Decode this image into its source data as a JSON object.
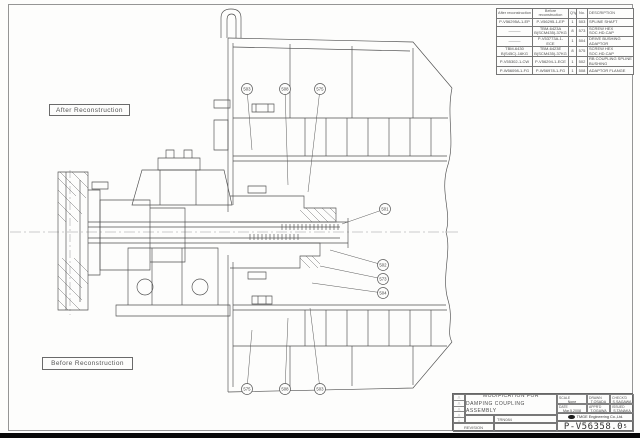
{
  "labels": {
    "after": "After Reconstruction",
    "before": "Before Reconstruction"
  },
  "parts_table": {
    "headers": [
      "After reconstruction",
      "Before reconstruction",
      "Q'ty",
      "No.",
      "DESCRIPTION"
    ],
    "rows": [
      [
        "P-V56295A-1-EP",
        "P-V56295-1-EP",
        "1",
        "503",
        "SPLINE SHAFT"
      ],
      [
        "———",
        "TBM-6423A B(SCM435)-37KG",
        "8",
        "573",
        "SCREW HEX SOC.HD.CAP"
      ],
      [
        "———",
        "P-V53773A-1-ECE",
        "1",
        "504",
        "DRIVE BUSHING ADAPTOR"
      ],
      [
        "TBM-6430 B(S45C)-16KG",
        "TBM-6423E B(SCM435)-37KG",
        "8",
        "575",
        "SCREW HEX SOC.HD.CAP"
      ],
      [
        "P-V55302-1-CW",
        "P-V56294-1-ECE",
        "1",
        "502",
        "RB COUPLING SPLINE BUSHING"
      ],
      [
        "P-W56098-1-FG",
        "P-W56978-1-FG",
        "1",
        "508",
        "ADAPTOR FLANGE"
      ]
    ]
  },
  "balloons": [
    {
      "label": "503",
      "x": 247,
      "y": 89,
      "lx": 252,
      "ly": 150
    },
    {
      "label": "508",
      "x": 285,
      "y": 89,
      "lx": 288,
      "ly": 185
    },
    {
      "label": "575",
      "x": 320,
      "y": 89,
      "lx": 308,
      "ly": 192
    },
    {
      "label": "501",
      "x": 385,
      "y": 209,
      "lx": 342,
      "ly": 224
    },
    {
      "label": "502",
      "x": 383,
      "y": 265,
      "lx": 330,
      "ly": 250
    },
    {
      "label": "573",
      "x": 383,
      "y": 279,
      "lx": 320,
      "ly": 266
    },
    {
      "label": "504",
      "x": 383,
      "y": 293,
      "lx": 312,
      "ly": 283
    },
    {
      "label": "575",
      "x": 247,
      "y": 389,
      "lx": 252,
      "ly": 330
    },
    {
      "label": "508",
      "x": 285,
      "y": 389,
      "lx": 288,
      "ly": 318
    },
    {
      "label": "503",
      "x": 320,
      "y": 389,
      "lx": 310,
      "ly": 308
    }
  ],
  "title_block": {
    "title_line1": "MODIFICATION FOR",
    "title_line2": "DAMPING COUPLING ASSEMBLY",
    "doc_code": "TRN084",
    "revision_label": "REVISION",
    "drawing_number": "P-V56358.0",
    "drawing_number_suffix": "5",
    "company": "TMGE Engineering Co.,Ltd.",
    "fields": {
      "scale_label": "SCALE",
      "scale_value": "None",
      "drawn_label": "DRAWN",
      "drawn_value": "T.OSADA",
      "checked_label": "CHECK'D",
      "checked_value": "S.SAGAWA",
      "date_label": "DATE",
      "date_value": "Mar.5.2008",
      "approved_label": "APPR'D",
      "approved_value": "T.OGAWA",
      "issued_label": "ISSUED",
      "issued_value": "S.TANAKA"
    }
  },
  "icons": {
    "revision_triangle": "△"
  }
}
